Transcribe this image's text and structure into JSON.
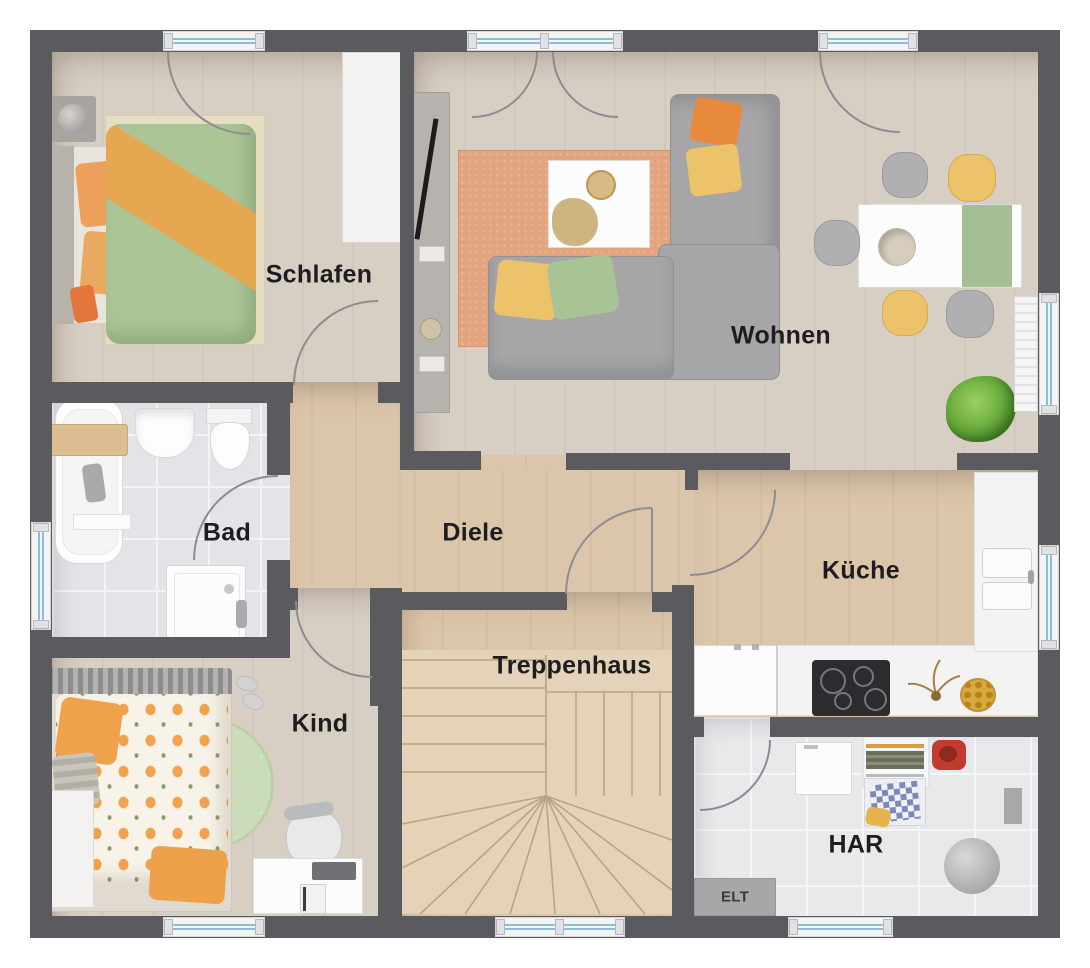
{
  "floorplan": {
    "labels": {
      "schlafen": "Schlafen",
      "wohnen": "Wohnen",
      "bad": "Bad",
      "diele": "Diele",
      "kueche": "Küche",
      "kind": "Kind",
      "treppenhaus": "Treppenhaus",
      "har": "HAR",
      "elt": "ELT"
    },
    "colors": {
      "wall": "#5a5a5f",
      "floor_wood_light": "#d8cfc4",
      "floor_wood_tan": "#dcc6ab",
      "floor_tile": "#e3e4e7",
      "window_glass": "#8fbdd6",
      "accent_orange": "#e8a14e",
      "accent_green": "#aac497",
      "accent_yellow": "#ecc26a",
      "rug_terracotta": "#e2a57e",
      "label_text": "#1d1d1f"
    }
  }
}
